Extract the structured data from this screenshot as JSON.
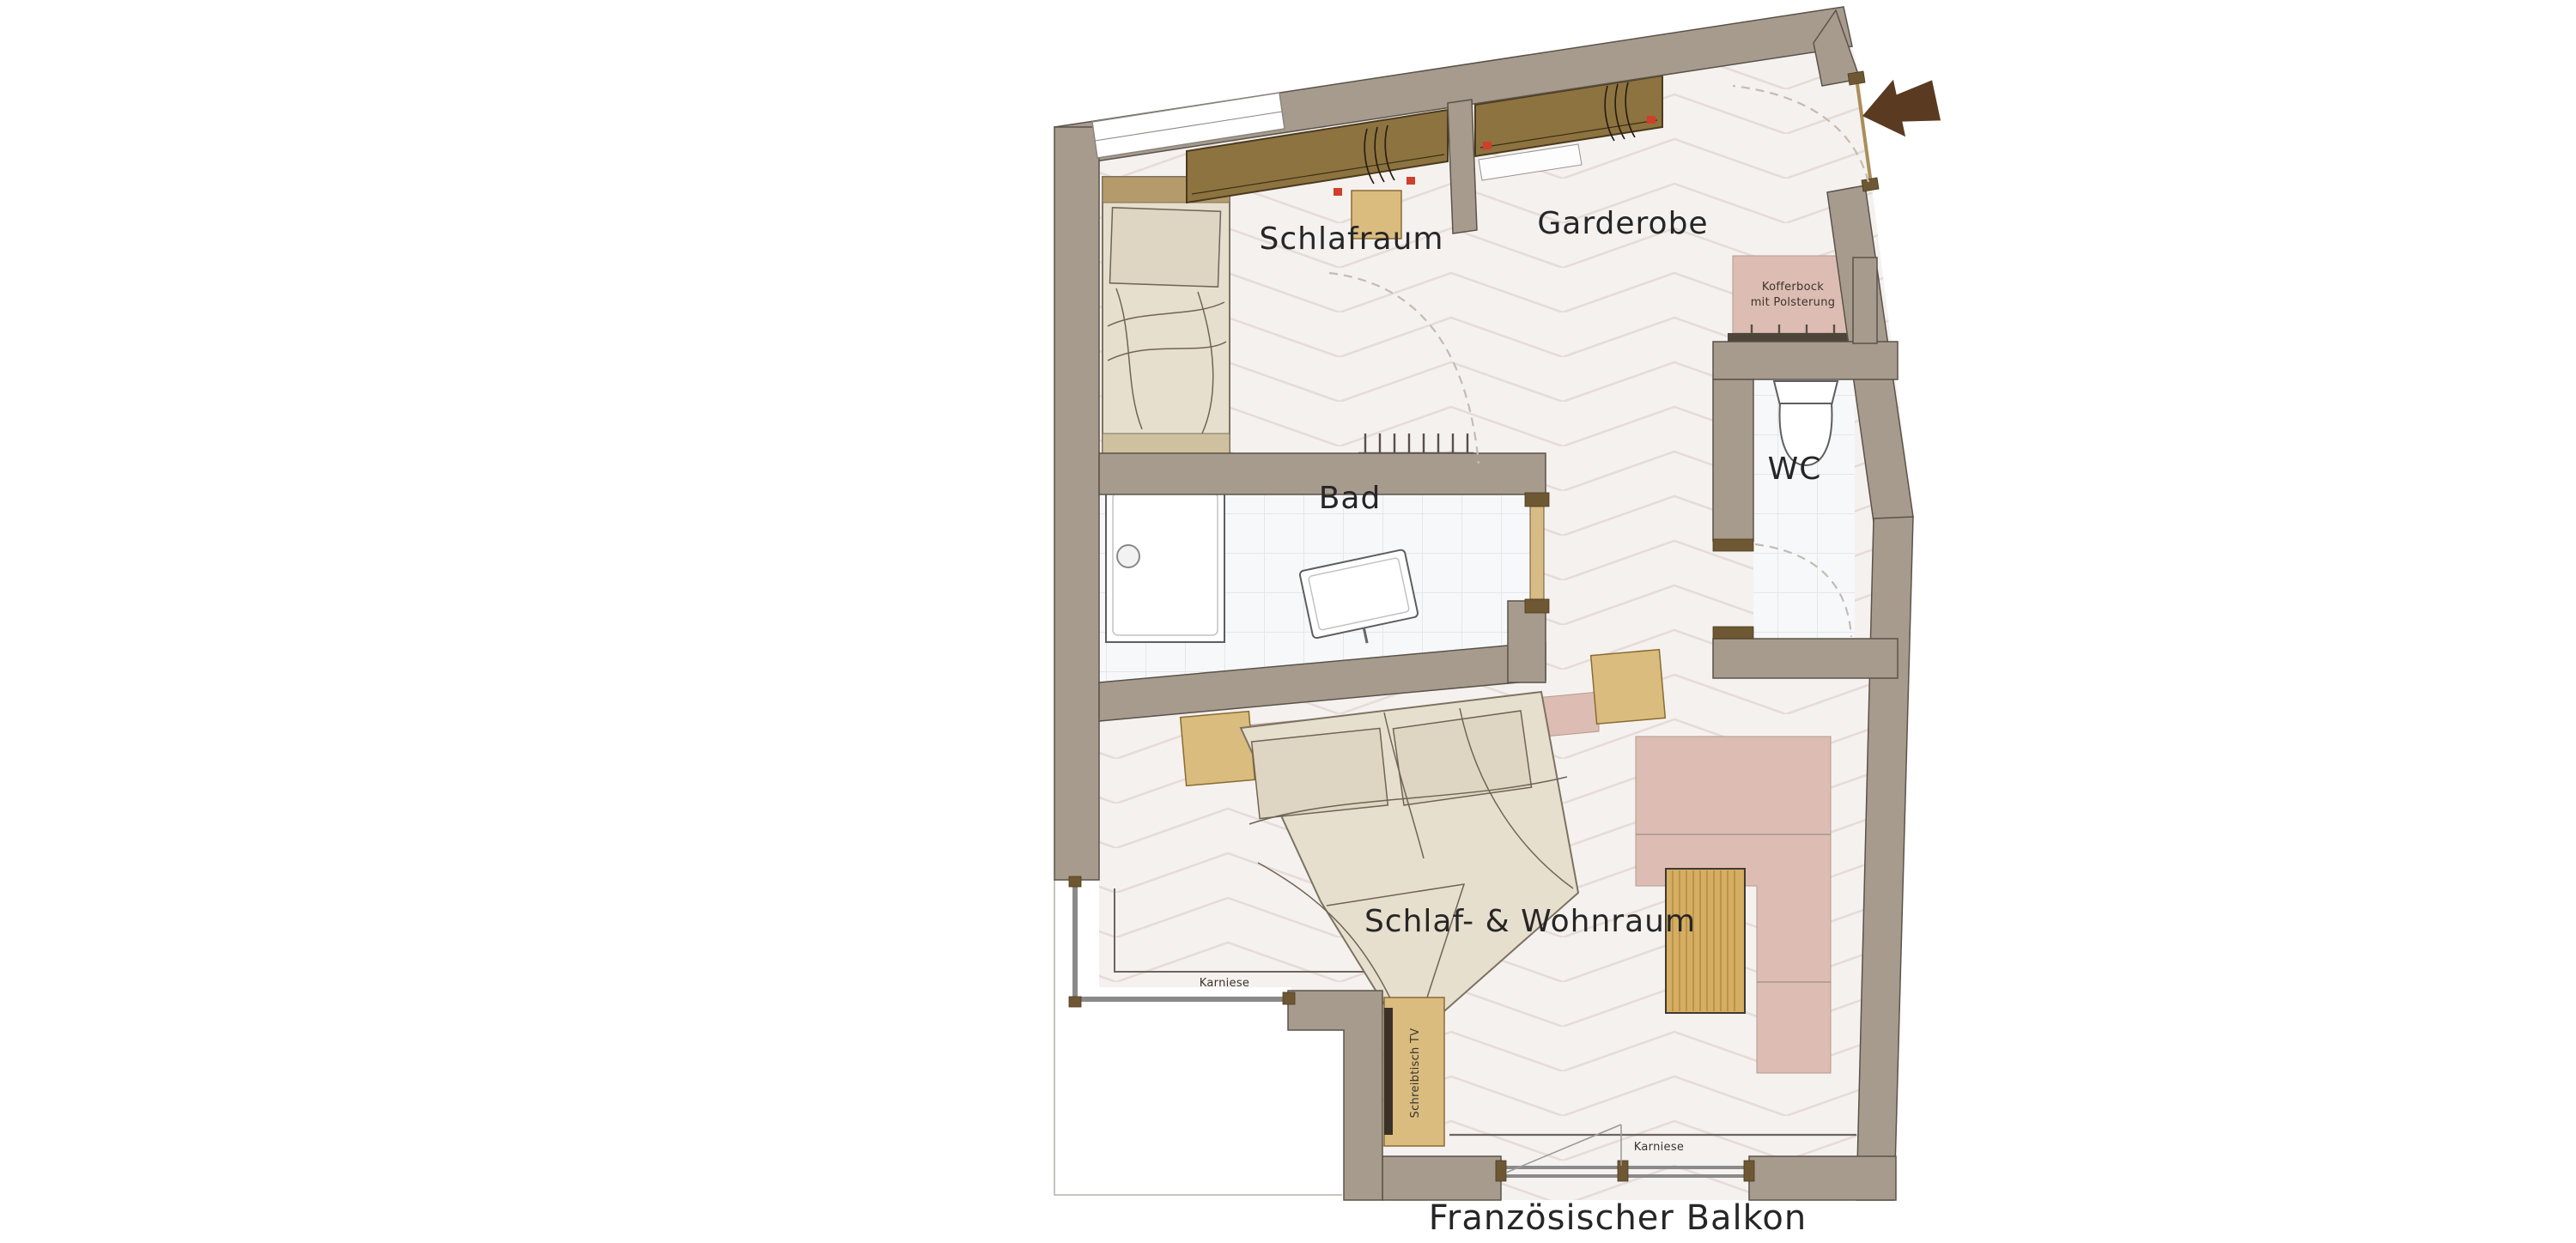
{
  "plan": {
    "labels": {
      "schlafraum": "Schlafraum",
      "garderobe": "Garderobe",
      "bad": "Bad",
      "wc": "WC",
      "wohnraum": "Schlaf- & Wohnraum",
      "balkon": "Französischer Balkon",
      "kofferbock_line1": "Kofferbock",
      "kofferbock_line2": "mit Polsterung",
      "karniese_left": "Karniese",
      "karniese_bottom": "Karniese",
      "schreibtisch": "Schreibtisch TV"
    },
    "icons": {
      "entrance_arrow": "entrance-direction-arrow"
    },
    "colors": {
      "wall": "#a79b8d",
      "wall_outline": "#5a534a",
      "floor": "#f5f1ef",
      "floor_line": "#e6dbd7",
      "tile": "#f7f8fa",
      "tile_line": "#e4e7ea",
      "wood_dark": "#8d7340",
      "wood_light": "#dabc7f",
      "upholstery_pink": "#ddbdb3",
      "bed_linen": "#e7dfce",
      "arrow_brown": "#5a3b22",
      "text": "#262626"
    }
  }
}
